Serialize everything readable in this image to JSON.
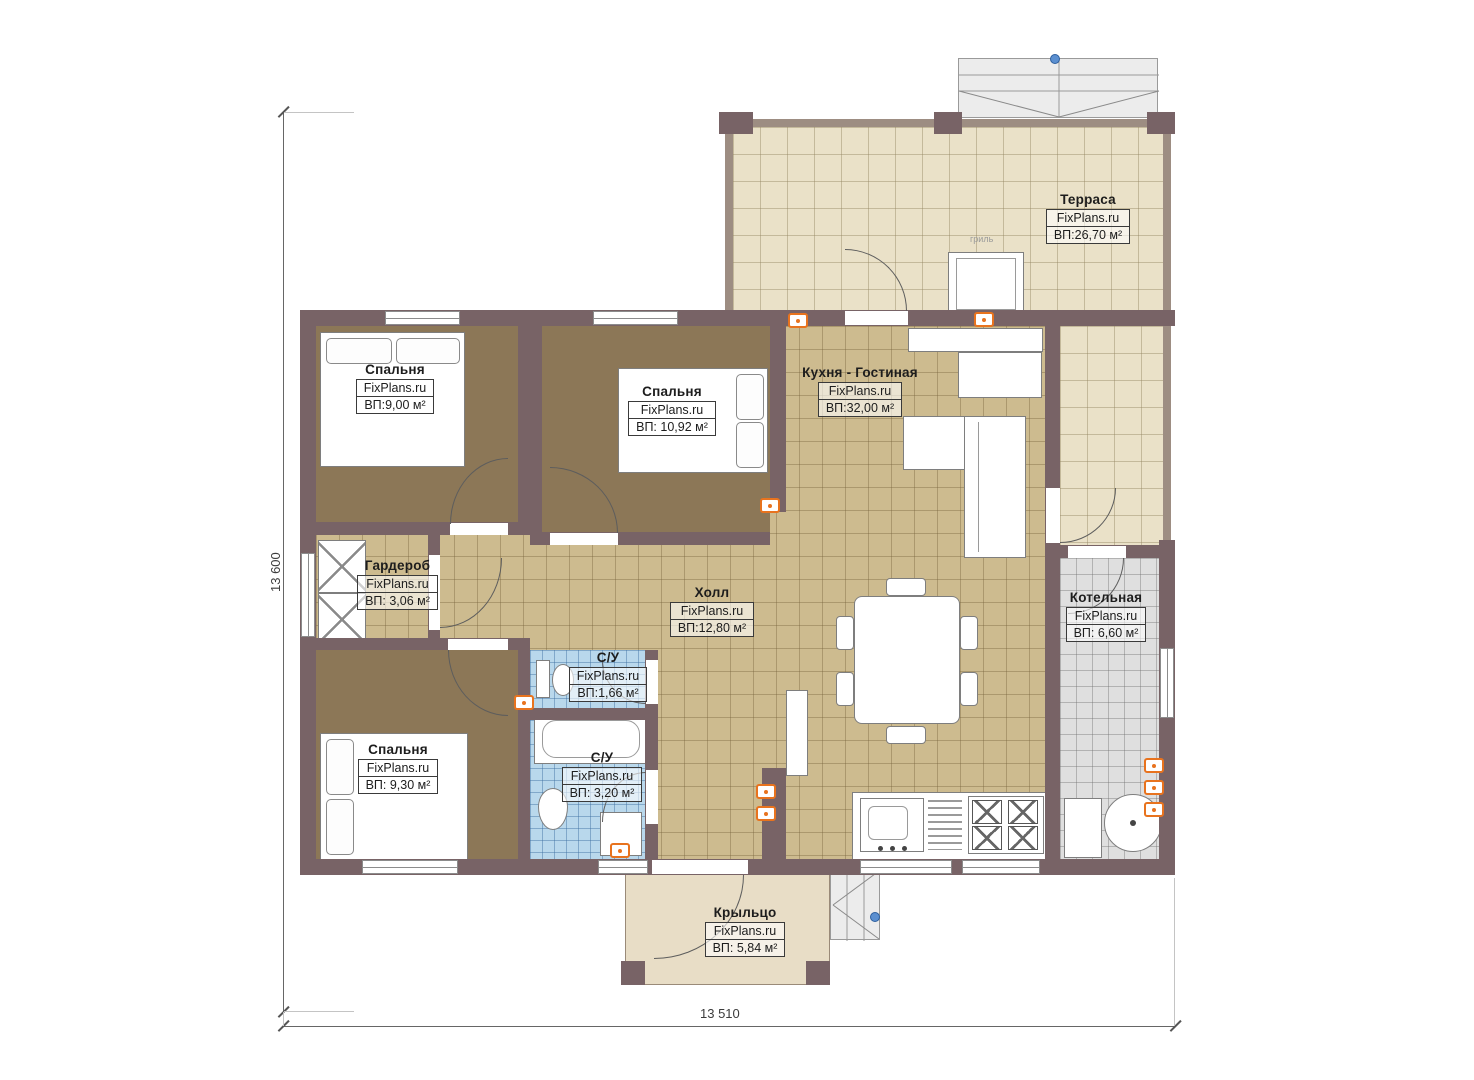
{
  "plan": {
    "watermark": "FixPlans.ru",
    "dim_left": "13 600",
    "dim_bottom": "13 510",
    "grill": "гриль",
    "colors": {
      "wall": "#786366",
      "bedroom_floor": "#8c7757",
      "hall_tile": "#cdbb8f",
      "terrace_floor": "#eae1c8",
      "bath_tile": "#b9d8ec",
      "boiler_tile": "#dfdfdf",
      "socket_accent": "#e8731e",
      "marker_blue": "#5b8fd0"
    }
  },
  "rooms": {
    "terrace": {
      "name": "Терраса",
      "brand": "FixPlans.ru",
      "area": "ВП:26,70 м²"
    },
    "bedroom1": {
      "name": "Спальня",
      "brand": "FixPlans.ru",
      "area": "ВП:9,00 м²"
    },
    "bedroom2": {
      "name": "Спальня",
      "brand": "FixPlans.ru",
      "area": "ВП: 10,92 м²"
    },
    "kitchen_living": {
      "name": "Кухня - Гостиная",
      "brand": "FixPlans.ru",
      "area": "ВП:32,00 м²"
    },
    "wardrobe": {
      "name": "Гардероб",
      "brand": "FixPlans.ru",
      "area": "ВП: 3,06 м²"
    },
    "hall": {
      "name": "Холл",
      "brand": "FixPlans.ru",
      "area": "ВП:12,80 м²"
    },
    "boiler": {
      "name": "Котельная",
      "brand": "FixPlans.ru",
      "area": "ВП: 6,60 м²"
    },
    "bath1": {
      "name": "С/У",
      "brand": "FixPlans.ru",
      "area": "ВП:1,66 м²"
    },
    "bath2": {
      "name": "С/У",
      "brand": "FixPlans.ru",
      "area": "ВП: 3,20 м²"
    },
    "bedroom3": {
      "name": "Спальня",
      "brand": "FixPlans.ru",
      "area": "ВП: 9,30 м²"
    },
    "porch": {
      "name": "Крыльцо",
      "brand": "FixPlans.ru",
      "area": "ВП: 5,84 м²"
    }
  }
}
